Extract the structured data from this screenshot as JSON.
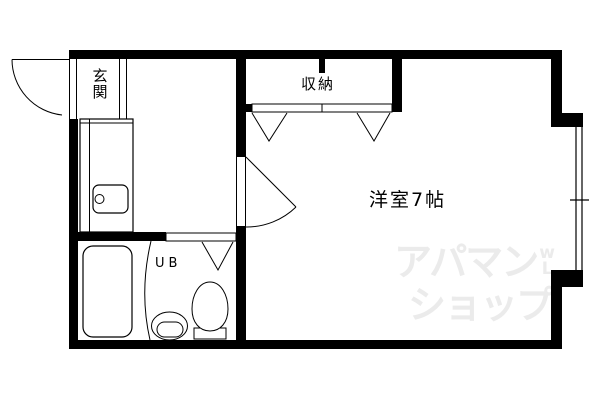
{
  "floorplan": {
    "background_color": "#ffffff",
    "wall_color": "#000000",
    "line_color": "#000000",
    "rooms": {
      "entrance": {
        "label": "玄関"
      },
      "closet": {
        "label": "収納"
      },
      "western_room": {
        "label": "洋室7帖"
      },
      "unit_bath": {
        "label": "UB"
      }
    },
    "fixtures": [
      "kitchen-counter",
      "kitchen-sink",
      "faucet",
      "bathtub",
      "washbasin",
      "toilet"
    ],
    "openings": [
      "entrance-swing-door",
      "room-swing-door",
      "closet-folding-doors",
      "bath-folding-door",
      "window"
    ]
  },
  "watermark": {
    "line1": "アパマン",
    "line2": "ショップ",
    "logo_top": "w",
    "logo_bottom": "L",
    "color": "#ebebeb"
  }
}
